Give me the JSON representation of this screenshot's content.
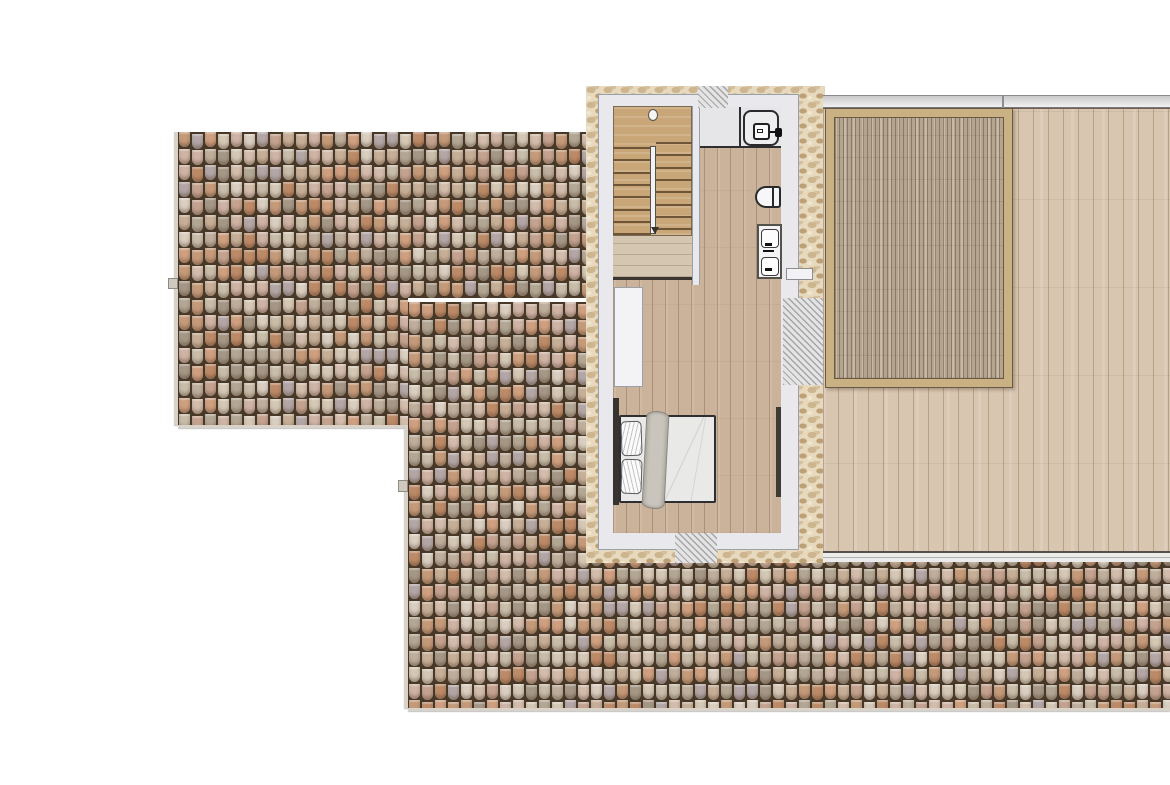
{
  "scene": {
    "background": "#ffffff",
    "kind": "architectural-floor-plan-top-view"
  },
  "roof": {
    "tile_gap_color": "#483827",
    "tile_w": 13,
    "tile_h": 16.6,
    "tile_palette": [
      "#c8bda9",
      "#b3a794",
      "#d4c8b5",
      "#c59a79",
      "#cfb3a4",
      "#b3a6a6",
      "#d9cec0",
      "#bd8a67",
      "#c7af97",
      "#a59786",
      "#d3bcab",
      "#c4a28f",
      "#cf9f7f",
      "#bfae9c"
    ],
    "regions": [
      {
        "name": "roof-left",
        "x": 178,
        "y": 132,
        "w": 410,
        "h": 293,
        "clip": [
          [
            0,
            0
          ],
          [
            410,
            0
          ],
          [
            410,
            166
          ],
          [
            230,
            166
          ],
          [
            230,
            293
          ],
          [
            0,
            293
          ]
        ],
        "rule": "left"
      },
      {
        "name": "roof-lower",
        "x": 408,
        "y": 302,
        "w": 762,
        "h": 406,
        "clip": [
          [
            0,
            0
          ],
          [
            180,
            0
          ],
          [
            180,
            260
          ],
          [
            762,
            260
          ],
          [
            762,
            406
          ],
          [
            0,
            406
          ]
        ],
        "rule": "lower"
      }
    ]
  },
  "plan": {
    "stone_color": "#e6d9bd",
    "wall_color": "#e9e9ed",
    "floor_color": "#cbb29a",
    "outline_color": "#2b2b2e"
  },
  "stairs": {
    "flight_treads": 8,
    "tread_spacing": 12.3,
    "zone": {
      "x": 613,
      "y": 147,
      "w": 79,
      "h": 88
    },
    "left_offset": 0,
    "right_offset": -5
  },
  "terrace": {
    "deck_color": "#d8c6b1",
    "pergola_frame_color": "#cab183",
    "pergola_slat_color": "#b5a58e",
    "railing_band_color": "#e4e4e6"
  },
  "furniture": {
    "bed_duvet": "#e9e9e7",
    "bed_blanket": "#c9c5bc",
    "headboard": "#37332e",
    "fixture_white": "#f4f4f6"
  }
}
